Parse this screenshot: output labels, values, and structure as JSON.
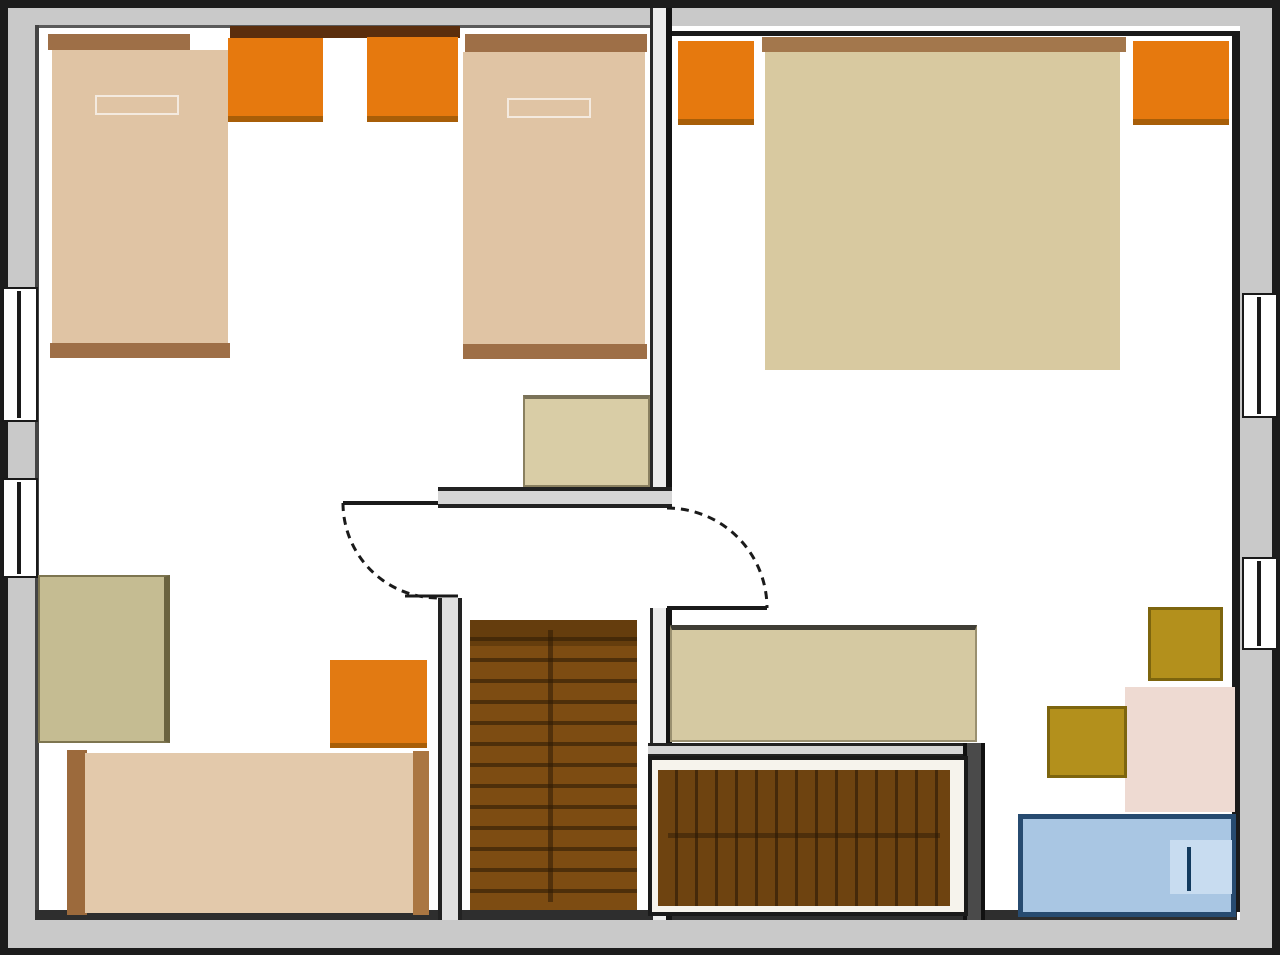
{
  "canvas": {
    "width": 1280,
    "height": 960,
    "background": "#ffffff"
  },
  "plan_type": "upper-floor-plan",
  "palette": {
    "wall_gray": "#c9c9c9",
    "wall_line": "#1c1c1c",
    "bed_tan": "#e0c4a4",
    "bed_khaki": "#d8c9a0",
    "wood_brown": "#9e6f47",
    "dark_shelf_brown": "#5b2e0d",
    "nightstand_orange": "#e6790e",
    "stairs_brown": "#7d4c12",
    "stool_mustard": "#b3901c",
    "table_pink": "#eedad2",
    "tub_blue": "#a9c6e3",
    "tub_border_blue": "#274b70"
  },
  "walls": [
    {
      "name": "top-wall-outer-edge",
      "x": 0,
      "y": 0,
      "w": 1280,
      "h": 8,
      "fill": "#1c1c1c"
    },
    {
      "name": "left-wall-outer-edge",
      "x": 0,
      "y": 0,
      "w": 8,
      "h": 955,
      "fill": "#1c1c1c"
    },
    {
      "name": "right-wall-outer-edge",
      "x": 1272,
      "y": 0,
      "w": 8,
      "h": 955,
      "fill": "#1c1c1c"
    },
    {
      "name": "bottom-wall-outer-edge",
      "x": 0,
      "y": 948,
      "w": 1280,
      "h": 7,
      "fill": "#1c1c1c"
    },
    {
      "name": "top-wall",
      "x": 8,
      "y": 8,
      "w": 1264,
      "h": 18,
      "fill": "#c9c9c9"
    },
    {
      "name": "left-wall",
      "x": 8,
      "y": 8,
      "w": 30,
      "h": 940,
      "fill": "#c9c9c9"
    },
    {
      "name": "right-wall",
      "x": 1240,
      "y": 8,
      "w": 32,
      "h": 940,
      "fill": "#c9c9c9"
    },
    {
      "name": "bottom-wall",
      "x": 8,
      "y": 920,
      "w": 1264,
      "h": 28,
      "fill": "#c9c9c9"
    },
    {
      "name": "left-room-top-edge-line",
      "x": 36,
      "y": 25,
      "w": 616,
      "h": 3,
      "fill": "#5a5a5a"
    },
    {
      "name": "left-wall-inner-edge-line",
      "x": 35,
      "y": 25,
      "w": 4,
      "h": 887,
      "fill": "#444444"
    },
    {
      "name": "bottom-wall-inner-edge-line",
      "x": 35,
      "y": 910,
      "w": 1202,
      "h": 10,
      "fill": "#2e2e2e"
    },
    {
      "name": "right-room-top-edge-line",
      "x": 666,
      "y": 31,
      "w": 574,
      "h": 5,
      "fill": "#1a1a1a"
    },
    {
      "name": "right-wall-inner-edge-line",
      "x": 1232,
      "y": 31,
      "w": 8,
      "h": 881,
      "fill": "#1a1a1a"
    },
    {
      "name": "divider-wall-upper",
      "x": 650,
      "y": 8,
      "w": 22,
      "h": 497,
      "fill": "#ececec",
      "style": "border-left:3px solid #2a2a2a;border-right:6px solid #141414"
    },
    {
      "name": "divider-wall-lower",
      "x": 650,
      "y": 608,
      "w": 22,
      "h": 312,
      "fill": "#ececec",
      "style": "border-left:3px solid #2a2a2a;border-right:6px solid #141414"
    },
    {
      "name": "stair-enclosure-west-wall-upper",
      "x": 438,
      "y": 487,
      "w": 24,
      "h": 16,
      "fill": "#e0e0e0",
      "style": "border-left:4px solid #222222;border-right:4px solid #222222"
    },
    {
      "name": "stair-enclosure-west-wall-lower",
      "x": 438,
      "y": 598,
      "w": 24,
      "h": 322,
      "fill": "#e0e0e0",
      "style": "border-left:4px solid #222222;border-right:4px solid #222222"
    },
    {
      "name": "stair-enclosure-north-wall",
      "x": 438,
      "y": 487,
      "w": 234,
      "h": 21,
      "fill": "#d6d6d6",
      "style": "border-top:4px solid #222222;border-bottom:4px solid #222222"
    },
    {
      "name": "lower-stairs-north-wall",
      "x": 648,
      "y": 743,
      "w": 337,
      "h": 14,
      "fill": "#d6d6d6",
      "style": "border-top:3px solid #222222;border-bottom:3px solid #222222"
    },
    {
      "name": "lower-stairs-east-wall",
      "x": 963,
      "y": 743,
      "w": 22,
      "h": 177,
      "fill": "#4a4a4a",
      "style": "border-left:4px solid #111111;border-right:4px solid #111111"
    }
  ],
  "furniture": [
    {
      "name": "single-bed-1-headboard",
      "x": 48,
      "y": 34,
      "w": 142,
      "h": 16,
      "fill": "#9e6f47"
    },
    {
      "name": "single-bed-1",
      "x": 52,
      "y": 50,
      "w": 176,
      "h": 296,
      "fill": "#e0c4a4"
    },
    {
      "name": "single-bed-1-footboard",
      "x": 50,
      "y": 343,
      "w": 180,
      "h": 15,
      "fill": "#9e6f47"
    },
    {
      "name": "single-bed-1-pillow",
      "kind": "pillow",
      "x": 95,
      "y": 95,
      "w": 84,
      "h": 20
    },
    {
      "name": "headboard-shelf",
      "x": 230,
      "y": 26,
      "w": 230,
      "h": 12,
      "fill": "#5b2e0d"
    },
    {
      "name": "nightstand-1",
      "x": 228,
      "y": 38,
      "w": 95,
      "h": 84,
      "fill": "#e6790e",
      "style": "border-bottom:6px solid #a85e08"
    },
    {
      "name": "nightstand-2",
      "x": 367,
      "y": 37,
      "w": 91,
      "h": 85,
      "fill": "#e6790e",
      "style": "border-bottom:6px solid #a85e08"
    },
    {
      "name": "single-bed-2-headboard",
      "x": 465,
      "y": 34,
      "w": 182,
      "h": 18,
      "fill": "#9e6f47"
    },
    {
      "name": "single-bed-2",
      "x": 463,
      "y": 52,
      "w": 182,
      "h": 294,
      "fill": "#e0c4a4"
    },
    {
      "name": "single-bed-2-footboard",
      "x": 463,
      "y": 344,
      "w": 184,
      "h": 15,
      "fill": "#9e6f47"
    },
    {
      "name": "single-bed-2-pillow",
      "kind": "pillow",
      "x": 507,
      "y": 98,
      "w": 84,
      "h": 20
    },
    {
      "name": "double-bed-headboard",
      "x": 762,
      "y": 37,
      "w": 364,
      "h": 15,
      "fill": "#a3774c"
    },
    {
      "name": "double-bed",
      "x": 765,
      "y": 52,
      "w": 355,
      "h": 318,
      "fill": "#d8c9a0"
    },
    {
      "name": "nightstand-3",
      "x": 678,
      "y": 41,
      "w": 76,
      "h": 84,
      "fill": "#e6790e",
      "style": "border-bottom:6px solid #a85e08"
    },
    {
      "name": "nightstand-4",
      "x": 1133,
      "y": 41,
      "w": 96,
      "h": 84,
      "fill": "#e6790e",
      "style": "border-bottom:6px solid #a85e08"
    },
    {
      "name": "chest-of-drawers",
      "x": 523,
      "y": 395,
      "w": 127,
      "h": 92,
      "fill": "#d9cda6",
      "style": "border:2px solid #8a8060;border-top:4px solid #7a7258"
    },
    {
      "name": "desk-left",
      "x": 38,
      "y": 575,
      "w": 132,
      "h": 168,
      "fill": "#c5bc92",
      "style": "border:2px solid #7d7550;border-right:6px solid #6b6340"
    },
    {
      "name": "cabinet-orange",
      "x": 330,
      "y": 660,
      "w": 97,
      "h": 88,
      "fill": "#e27a12",
      "style": "border-bottom:5px solid #a85e08"
    },
    {
      "name": "single-bed-3-headboard",
      "x": 67,
      "y": 750,
      "w": 20,
      "h": 165,
      "fill": "#9c6a3c"
    },
    {
      "name": "single-bed-3",
      "x": 85,
      "y": 753,
      "w": 330,
      "h": 160,
      "fill": "#e3c9ab"
    },
    {
      "name": "single-bed-3-footboard",
      "x": 413,
      "y": 751,
      "w": 16,
      "h": 164,
      "fill": "#aa7642"
    },
    {
      "name": "staircase-upper-flight",
      "kind": "stairs-v",
      "x": 470,
      "y": 620,
      "w": 167,
      "h": 290
    },
    {
      "name": "staircase-upper-top-shade",
      "x": 470,
      "y": 620,
      "w": 167,
      "h": 26,
      "fill": "rgba(58,33,6,0.35)"
    },
    {
      "name": "staircase-upper-grain",
      "x": 548,
      "y": 630,
      "w": 5,
      "h": 272,
      "fill": "rgba(48,27,6,0.55)"
    },
    {
      "name": "sideboard-right",
      "x": 670,
      "y": 625,
      "w": 307,
      "h": 117,
      "fill": "#d5c9a2",
      "style": "border:2px solid #9a9070;border-top:5px solid #3f3d35"
    },
    {
      "name": "staircase-lower-frame",
      "x": 648,
      "y": 756,
      "w": 320,
      "h": 160,
      "fill": "#f6f3ec",
      "style": "border:4px solid #1a1a1a"
    },
    {
      "name": "staircase-lower-flight",
      "kind": "stairs-h",
      "x": 658,
      "y": 770,
      "w": 292,
      "h": 136
    },
    {
      "name": "staircase-lower-grain",
      "x": 668,
      "y": 833,
      "w": 272,
      "h": 5,
      "fill": "rgba(40,24,6,0.45)"
    },
    {
      "name": "side-table-pink",
      "x": 1125,
      "y": 687,
      "w": 110,
      "h": 125,
      "fill": "#eedad2"
    },
    {
      "name": "stool-1",
      "x": 1148,
      "y": 607,
      "w": 75,
      "h": 74,
      "fill": "#b3901c",
      "style": "border:3px solid #7d650e"
    },
    {
      "name": "stool-2",
      "x": 1047,
      "y": 706,
      "w": 80,
      "h": 72,
      "fill": "#b3901c",
      "style": "border:3px solid #7d650e"
    },
    {
      "name": "bathtub",
      "x": 1018,
      "y": 814,
      "w": 218,
      "h": 103,
      "fill": "#a9c6e3",
      "style": "border:5px solid #274b70"
    },
    {
      "name": "bathtub-step",
      "x": 1170,
      "y": 840,
      "w": 62,
      "h": 54,
      "fill": "#c8dcf0"
    },
    {
      "name": "bathtub-fitting",
      "x": 1187,
      "y": 847,
      "w": 4,
      "h": 44,
      "fill": "#123a5e"
    }
  ],
  "windows": [
    {
      "name": "window-left-upper",
      "kind": "window",
      "x": 2,
      "y": 287,
      "w": 36,
      "h": 135
    },
    {
      "name": "window-left-upper-glass",
      "x": 17,
      "y": 291,
      "w": 4,
      "h": 127,
      "fill": "#1a1a1a"
    },
    {
      "name": "window-left-lower",
      "kind": "window",
      "x": 2,
      "y": 478,
      "w": 36,
      "h": 100
    },
    {
      "name": "window-left-lower-glass",
      "x": 17,
      "y": 482,
      "w": 4,
      "h": 92,
      "fill": "#1a1a1a"
    },
    {
      "name": "window-right-upper",
      "kind": "window",
      "x": 1242,
      "y": 293,
      "w": 36,
      "h": 125
    },
    {
      "name": "window-right-upper-glass",
      "x": 1257,
      "y": 297,
      "w": 4,
      "h": 117,
      "fill": "#1a1a1a"
    },
    {
      "name": "window-right-lower",
      "kind": "window",
      "x": 1242,
      "y": 557,
      "w": 36,
      "h": 93
    },
    {
      "name": "window-right-lower-glass",
      "x": 1257,
      "y": 561,
      "w": 4,
      "h": 85,
      "fill": "#1a1a1a"
    }
  ],
  "doors": [
    {
      "name": "door-left-room",
      "leaf": {
        "x1": 343,
        "y1": 503,
        "x2": 438,
        "y2": 503
      },
      "arc": "M 343 503 A 95 95 0 0 0 438 598",
      "jamb": {
        "x1": 405,
        "y1": 596,
        "x2": 458,
        "y2": 596
      }
    },
    {
      "name": "door-right-room",
      "leaf": {
        "x1": 667,
        "y1": 608,
        "x2": 767,
        "y2": 608
      },
      "arc": "M 667 508 A 100 100 0 0 1 767 608"
    }
  ],
  "stroke": {
    "color": "#1a1a1a",
    "leaf_width": 4,
    "arc_width": 3,
    "arc_dash": "8 6"
  }
}
